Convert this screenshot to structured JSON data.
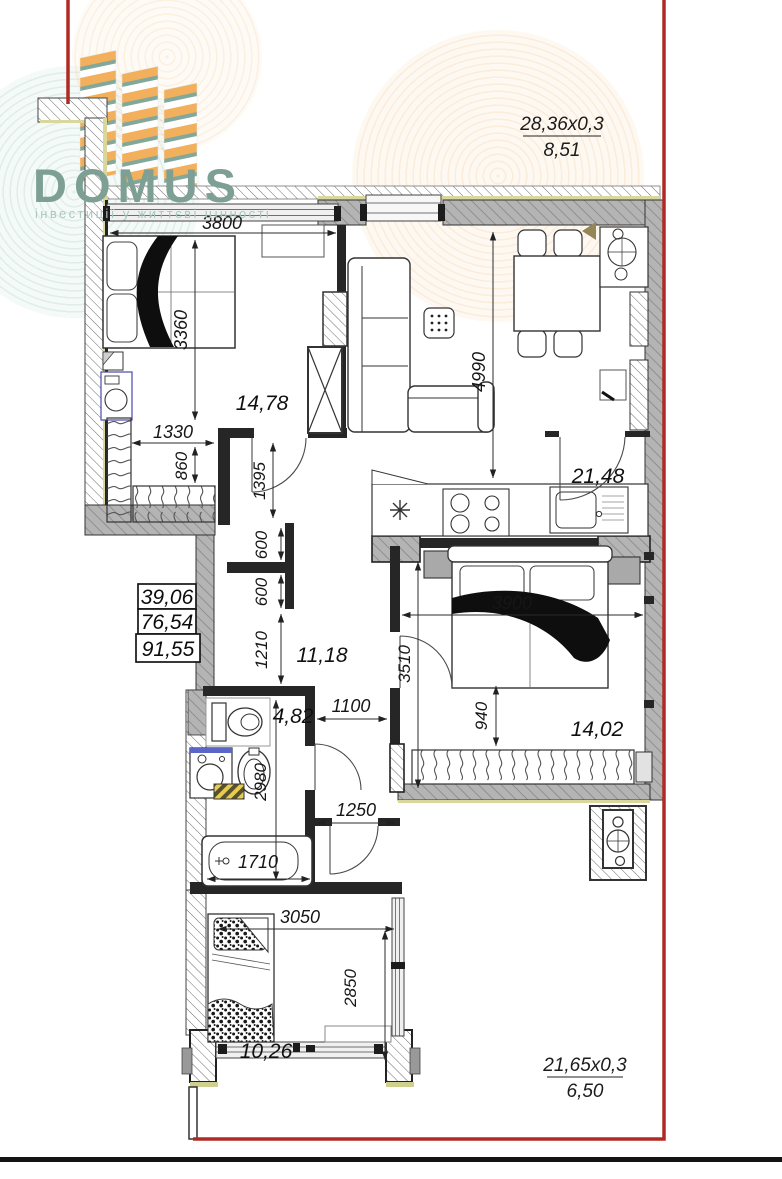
{
  "logo": {
    "brand": "DOMUS",
    "tagline": "інвестиції у життєві цінності"
  },
  "wall_calcs": {
    "top": {
      "formula": "28,36x0,3",
      "result": "8,51"
    },
    "bottom": {
      "formula": "21,65x0,3",
      "result": "6,50"
    }
  },
  "area_summary": {
    "living": "39,06",
    "apartment": "76,54",
    "total": "91,55"
  },
  "rooms": {
    "bedroom_top": {
      "area": "14,78"
    },
    "kitchen_living": {
      "area": "21,48"
    },
    "hallway": {
      "area": "11,18"
    },
    "bedroom_right": {
      "area": "14,02"
    },
    "bathroom": {
      "area": "4,82"
    },
    "bedroom_bottom": {
      "area": "10,26"
    }
  },
  "dimensions": {
    "bedroom_top_width": "3800",
    "bedroom_top_depth": "3360",
    "living_depth": "4990",
    "wardrobe_width": "1330",
    "wardrobe_depth": "860",
    "hall_wall": "1395",
    "niche_a": "600",
    "niche_b": "600",
    "hall_depth": "1210",
    "bedroom_right_width": "3900",
    "bedroom_right_depth": "3510",
    "bed_offset": "940",
    "hall_width": "1100",
    "bathroom_depth": "2980",
    "door_width": "1250",
    "bathtub_length": "1710",
    "bedroom_bottom_width": "3050",
    "bedroom_bottom_depth": "2850"
  },
  "colors": {
    "boundary_red": "#b02a24",
    "logo_teal": "#7d9f94",
    "tower_orange": "#f2b05c",
    "tower_teal": "#82a89b",
    "wall_gray": "#b4b4b4",
    "insulation": "#d9d79b"
  }
}
